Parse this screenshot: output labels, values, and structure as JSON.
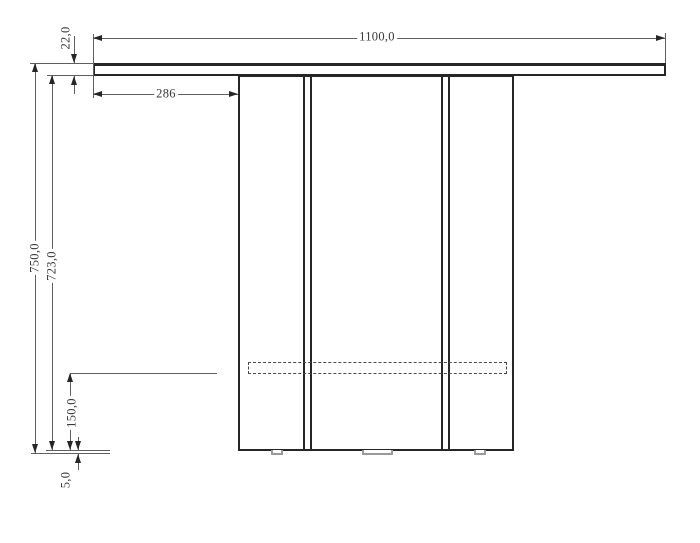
{
  "drawing": {
    "labels": {
      "width_top": "1100,0",
      "thickness_top": "22,0",
      "overhang_left": "286",
      "height_total": "750,0",
      "height_body": "723,0",
      "height_rail": "150,0",
      "height_foot": "5,0"
    },
    "colors": {
      "bg": "#ffffff",
      "line": "#262626",
      "thin": "#5f5f5f",
      "text": "#3a3a3a",
      "muted": "#9a9a9a"
    }
  }
}
